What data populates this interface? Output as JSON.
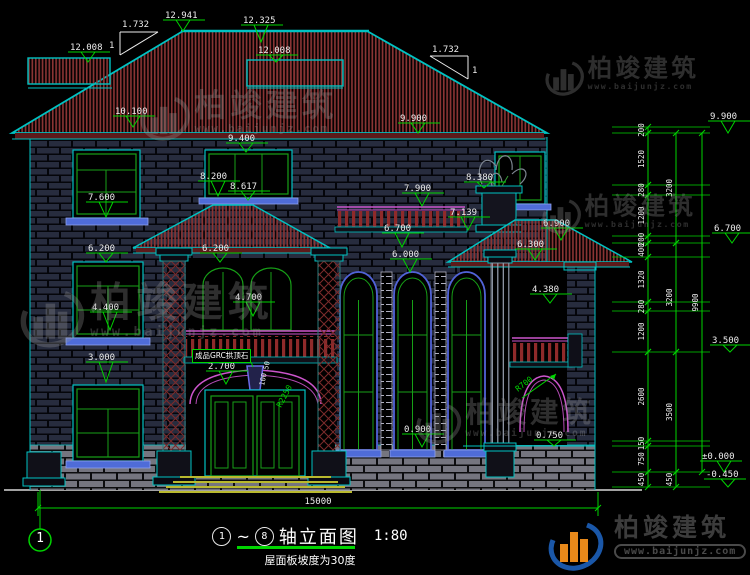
{
  "colors": {
    "teal": "#00c2c2",
    "green": "#00d400",
    "magenta": "#cc55cc",
    "roof_red": "#8a3434",
    "white": "#ededed",
    "blue": "#5163d8",
    "door_green": "#17a017"
  },
  "title_block": {
    "axis_from": "1",
    "axis_to": "8",
    "tilde": "~",
    "name": "轴立面图",
    "scale": "1:80",
    "subtitle": "屋面板坡度为30度"
  },
  "brand": {
    "name": "柏竣建筑",
    "url": "www.baijunjz.com"
  },
  "drawing": {
    "axis_bubble": "1",
    "keystone_label": "成品GRC拱顶石",
    "elevation_markers": [
      {
        "label": "12.008",
        "tx": 70,
        "ty": 42,
        "px": 88,
        "py": 62
      },
      {
        "label": "12.941",
        "tx": 165,
        "ty": 10,
        "px": 183,
        "py": 31
      },
      {
        "label": "12.325",
        "tx": 243,
        "ty": 15,
        "px": 261,
        "py": 42
      },
      {
        "label": "12.008",
        "tx": 258,
        "ty": 45,
        "px": 276,
        "py": 62
      },
      {
        "label": "10.100",
        "tx": 115,
        "ty": 106,
        "px": 133,
        "py": 127
      },
      {
        "label": "9.900",
        "tx": 400,
        "ty": 113,
        "px": 418,
        "py": 133
      },
      {
        "label": "9.400",
        "tx": 228,
        "ty": 133,
        "px": 246,
        "py": 152
      },
      {
        "label": "8.200",
        "tx": 200,
        "ty": 171,
        "px": 218,
        "py": 196
      },
      {
        "label": "8.617",
        "tx": 230,
        "ty": 181,
        "px": 248,
        "py": 200
      },
      {
        "label": "8.380",
        "tx": 466,
        "ty": 172,
        "px": 484,
        "py": 188
      },
      {
        "label": "7.600",
        "tx": 88,
        "ty": 192,
        "px": 106,
        "py": 217
      },
      {
        "label": "7.900",
        "tx": 404,
        "ty": 183,
        "px": 422,
        "py": 206
      },
      {
        "label": "7.139",
        "tx": 450,
        "ty": 207,
        "px": 468,
        "py": 230
      },
      {
        "label": "6.900",
        "tx": 543,
        "ty": 218,
        "px": 561,
        "py": 240
      },
      {
        "label": "6.700",
        "tx": 384,
        "ty": 223,
        "px": 402,
        "py": 247
      },
      {
        "label": "6.300",
        "tx": 517,
        "ty": 239,
        "px": 535,
        "py": 260
      },
      {
        "label": "6.200",
        "tx": 88,
        "ty": 243,
        "px": 106,
        "py": 262
      },
      {
        "label": "6.200",
        "tx": 202,
        "ty": 243,
        "px": 220,
        "py": 262
      },
      {
        "label": "6.000",
        "tx": 392,
        "ty": 249,
        "px": 410,
        "py": 272
      },
      {
        "label": "4.700",
        "tx": 235,
        "ty": 292,
        "px": 253,
        "py": 316
      },
      {
        "label": "4.380",
        "tx": 532,
        "ty": 284,
        "px": 550,
        "py": 303
      },
      {
        "label": "4.400",
        "tx": 92,
        "ty": 302,
        "px": 110,
        "py": 330
      },
      {
        "label": "3.000",
        "tx": 88,
        "ty": 352,
        "px": 106,
        "py": 382
      },
      {
        "label": "2.700",
        "tx": 208,
        "ty": 361,
        "px": 226,
        "py": 384
      },
      {
        "label": "0.900",
        "tx": 404,
        "ty": 424,
        "px": 422,
        "py": 447
      },
      {
        "label": "0.750",
        "tx": 536,
        "ty": 430,
        "px": 554,
        "py": 446
      },
      {
        "label": "9.900",
        "tx": 710,
        "ty": 111,
        "px": 728,
        "py": 133
      },
      {
        "label": "6.700",
        "tx": 714,
        "ty": 223,
        "px": 732,
        "py": 243
      },
      {
        "label": "3.500",
        "tx": 712,
        "ty": 335,
        "px": 730,
        "py": 352
      },
      {
        "label": "±0.000",
        "tx": 702,
        "ty": 451,
        "px": 724,
        "py": 472
      },
      {
        "label": "-0.450",
        "tx": 706,
        "ty": 469,
        "px": 728,
        "py": 487
      }
    ],
    "dim_chains": {
      "right": [
        {
          "x": 648,
          "segments": [
            [
              "200",
              127,
              133
            ],
            [
              "1520",
              133,
              185
            ],
            [
              "280",
              185,
              195
            ],
            [
              "1200",
              195,
              236
            ],
            [
              "200",
              236,
              243
            ],
            [
              "400",
              243,
              257
            ],
            [
              "1320",
              257,
              302
            ],
            [
              "280",
              302,
              311
            ],
            [
              "1200",
              311,
              352
            ],
            [
              "2600",
              352,
              441
            ],
            [
              "150",
              441,
              446
            ],
            [
              "750",
              446,
              472
            ],
            [
              "450",
              472,
              487
            ]
          ]
        },
        {
          "x": 676,
          "segments": [
            [
              "3200",
              133,
              243
            ],
            [
              "3200",
              243,
              352
            ],
            [
              "3500",
              352,
              472
            ],
            [
              "450",
              472,
              487
            ]
          ]
        },
        {
          "x": 702,
          "segments": [
            [
              "9900",
              133,
              472
            ]
          ]
        }
      ],
      "extension_ys": [
        127,
        133,
        185,
        195,
        236,
        243,
        257,
        302,
        311,
        352,
        441,
        446,
        472,
        487
      ],
      "bottom": {
        "y": 508,
        "x1": 38,
        "x2": 598,
        "label": "15000"
      }
    },
    "annotations": [
      {
        "t": "1.732",
        "x": 122,
        "y": 27,
        "s": 9
      },
      {
        "t": "1",
        "x": 109,
        "y": 48,
        "s": 9
      },
      {
        "t": "1.732",
        "x": 432,
        "y": 52,
        "s": 9
      },
      {
        "t": "1",
        "x": 472,
        "y": 73,
        "s": 9
      },
      {
        "t": "15000",
        "x": 318,
        "y": 504,
        "s": 9,
        "a": "middle"
      },
      {
        "t": "R2250",
        "x": 281,
        "y": 408,
        "r": -62,
        "c": "g",
        "s": 8
      },
      {
        "t": "R700",
        "x": 518,
        "y": 392,
        "r": -38,
        "c": "g",
        "s": 8
      },
      {
        "t": "50",
        "x": 268,
        "y": 370,
        "r": -78,
        "s": 7
      },
      {
        "t": "100",
        "x": 264,
        "y": 386,
        "r": -78,
        "s": 7
      }
    ],
    "watermarks": [
      {
        "x": 140,
        "y": 90,
        "s": 1.05
      },
      {
        "x": 545,
        "y": 56,
        "s": 0.82
      },
      {
        "x": 542,
        "y": 194,
        "s": 0.82
      },
      {
        "x": 20,
        "y": 282,
        "s": 1.35
      },
      {
        "x": 416,
        "y": 398,
        "s": 0.95
      }
    ]
  }
}
